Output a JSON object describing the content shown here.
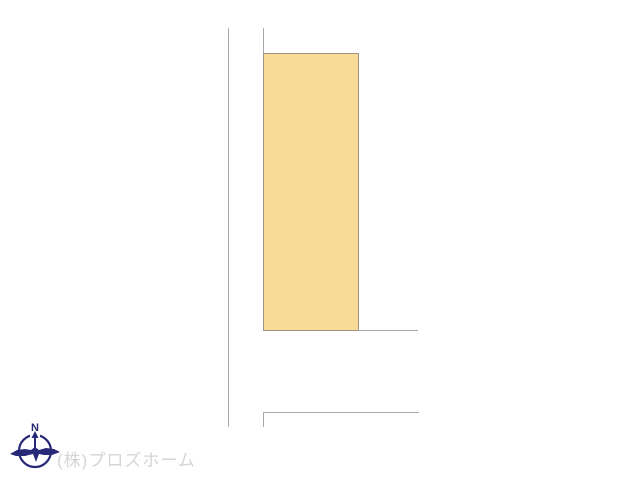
{
  "diagram": {
    "description": "land plot layout drawing",
    "plot_shape": "rectangle"
  },
  "compass": {
    "label": "N",
    "icon": "compass-north-icon"
  },
  "watermark": {
    "text": "(株)プロズホーム"
  },
  "colors": {
    "canvas-bg": "#ffffff",
    "line-color": "#a6a6ae",
    "plot-fill": "#f8db97",
    "plot-border": "#9f9382",
    "compass-color": "#282878",
    "watermark-color": "#d4d5d7"
  }
}
